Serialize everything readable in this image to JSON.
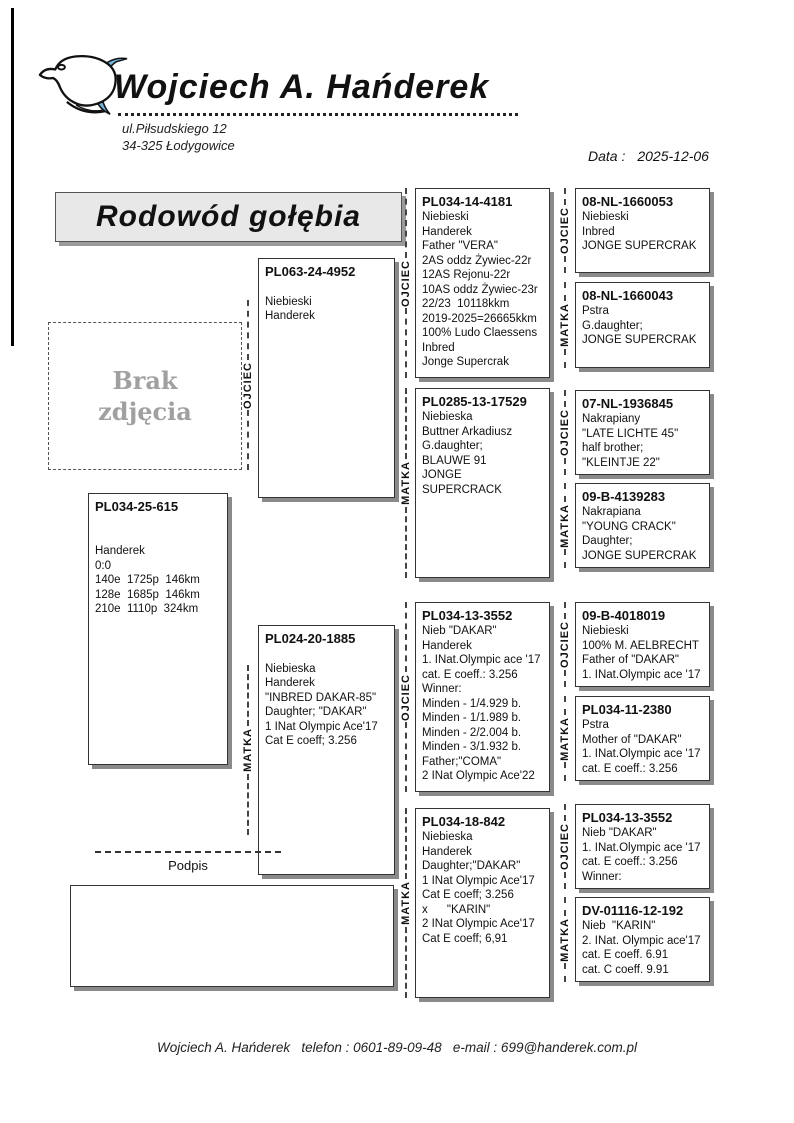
{
  "header": {
    "breeder_name": "Wojciech A. Hańderek",
    "address_line1": "ul.Piłsudskiego 12",
    "address_line2": "34-325 Łodygowice",
    "date_label": "Data :",
    "date_value": "2025-12-06",
    "logo_icon": "pigeon-logo"
  },
  "title": "Rodowód gołębia",
  "photo_placeholder": "Brak\nzdjęcia",
  "labels": {
    "father": "OJCIEC",
    "mother": "MATKA"
  },
  "signature_label": "Podpis",
  "footer": "Wojciech A. Hańderek   telefon : 0601-89-09-48   e-mail : 699@handerek.com.pl",
  "colors": {
    "accent_blue": "#74b2d6",
    "box_shadow": "#8a8a8a",
    "title_background": "#e8e8e8",
    "muted_text": "#a0a0a0"
  },
  "pedigree": {
    "subject": {
      "ring": "PL034-25-615",
      "lines": [
        "",
        "",
        "Handerek",
        "0:0",
        "140e  1725p  146km",
        "128e  1685p  146km",
        "210e  1110p  324km"
      ]
    },
    "gen2": [
      {
        "relation": "OJCIEC",
        "ring": "PL063-24-4952",
        "lines": [
          "",
          "Niebieski",
          "Handerek"
        ]
      },
      {
        "relation": "MATKA",
        "ring": "PL024-20-1885",
        "lines": [
          "",
          "Niebieska",
          "Handerek",
          "\"INBRED DAKAR-85\"",
          "Daughter; \"DAKAR\"",
          "1 INat Olympic Ace'17",
          "Cat E coeff; 3.256"
        ]
      }
    ],
    "gen3": [
      {
        "relation": "OJCIEC",
        "ring": "PL034-14-4181",
        "lines": [
          "Niebieski",
          "Handerek",
          "Father \"VERA\"",
          "2AS oddz Żywiec-22r",
          "12AS Rejonu-22r",
          "10AS oddz Żywiec-23r",
          "22/23  10118kkm",
          "2019-2025=26665kkm",
          "100% Ludo Claessens",
          "Inbred",
          "Jonge Supercrak"
        ]
      },
      {
        "relation": "MATKA",
        "ring": "PL0285-13-17529",
        "lines": [
          "Niebieska",
          "Buttner Arkadiusz",
          "G.daughter;",
          "BLAUWE 91",
          "JONGE SUPERCRACK"
        ]
      },
      {
        "relation": "OJCIEC",
        "ring": "PL034-13-3552",
        "lines": [
          "Nieb \"DAKAR\"",
          "Handerek",
          "1. INat.Olympic ace '17",
          "cat. E coeff.: 3.256",
          "Winner:",
          "Minden - 1/4.929 b.",
          "Minden - 1/1.989 b.",
          "Minden - 2/2.004 b.",
          "Minden - 3/1.932 b.",
          "Father;\"COMA\"",
          "2 INat Olympic Ace'22"
        ]
      },
      {
        "relation": "MATKA",
        "ring": "PL034-18-842",
        "lines": [
          "Niebieska",
          "Handerek",
          "Daughter;\"DAKAR\"",
          "1 INat Olympic Ace'17",
          "Cat E coeff; 3.256",
          "x      \"KARIN\"",
          "2 INat Olympic Ace'17",
          "Cat E coeff; 6,91"
        ]
      }
    ],
    "gen4": [
      {
        "relation": "OJCIEC",
        "ring": "08-NL-1660053",
        "lines": [
          "Niebieski",
          "Inbred",
          "JONGE SUPERCRAK"
        ]
      },
      {
        "relation": "MATKA",
        "ring": "08-NL-1660043",
        "lines": [
          "Pstra",
          "G.daughter;",
          "JONGE SUPERCRAK"
        ]
      },
      {
        "relation": "OJCIEC",
        "ring": "07-NL-1936845",
        "lines": [
          "Nakrapiany",
          "\"LATE LICHTE 45\"",
          "half brother;",
          "\"KLEINTJE 22\""
        ]
      },
      {
        "relation": "MATKA",
        "ring": "09-B-4139283",
        "lines": [
          "Nakrapiana",
          "\"YOUNG CRACK\"",
          "Daughter;",
          "JONGE SUPERCRAK"
        ]
      },
      {
        "relation": "OJCIEC",
        "ring": "09-B-4018019",
        "lines": [
          "Niebieski",
          "100% M. AELBRECHT",
          "Father of \"DAKAR\"",
          "1. INat.Olympic ace '17"
        ]
      },
      {
        "relation": "MATKA",
        "ring": "PL034-11-2380",
        "lines": [
          "Pstra",
          "Mother of \"DAKAR\"",
          "1. INat.Olympic ace '17",
          "cat. E coeff.: 3.256"
        ]
      },
      {
        "relation": "OJCIEC",
        "ring": "PL034-13-3552",
        "lines": [
          "Nieb \"DAKAR\"",
          "1. INat.Olympic ace '17",
          "cat. E coeff.: 3.256",
          "Winner:"
        ]
      },
      {
        "relation": "MATKA",
        "ring": "DV-01116-12-192",
        "lines": [
          "Nieb  \"KARIN\"",
          "2. INat. Olympic ace'17",
          "cat. E coeff. 6.91",
          "cat. C coeff. 9.91"
        ]
      }
    ]
  }
}
